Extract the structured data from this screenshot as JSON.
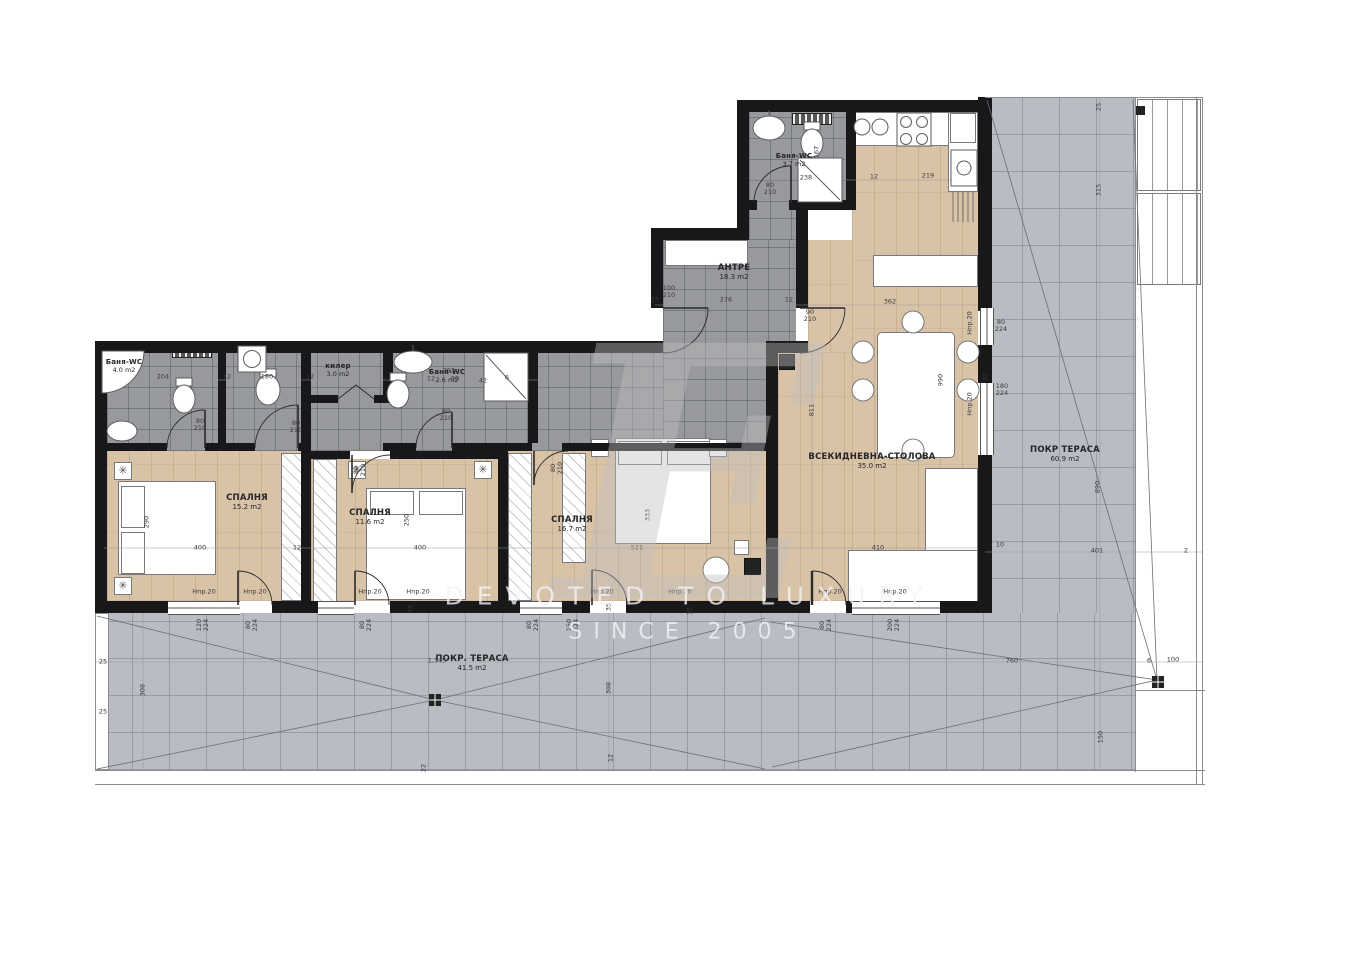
{
  "watermark": {
    "letter": "E",
    "line1": "DEVOTED TO LUXURY",
    "line2": "SINCE 2005"
  },
  "icons": {
    "ceiling_light": "✳"
  },
  "rooms": [
    {
      "id": "bath-1",
      "name": "Баня-WC",
      "area": "4.0 m2",
      "x": 124,
      "y": 366,
      "small": true
    },
    {
      "id": "bedroom-1",
      "name": "СПАЛНЯ",
      "area": "15.2 m2",
      "x": 247,
      "y": 502
    },
    {
      "id": "storage",
      "name": "килер",
      "area": "3.0 m2",
      "x": 338,
      "y": 370,
      "small": true
    },
    {
      "id": "bath-2",
      "name": "Баня-WC",
      "area": "2.6 m2",
      "x": 447,
      "y": 376,
      "small": true
    },
    {
      "id": "bedroom-2",
      "name": "СПАЛНЯ",
      "area": "11.6 m2",
      "x": 370,
      "y": 517
    },
    {
      "id": "bedroom-3",
      "name": "СПАЛНЯ",
      "area": "16.7 m2",
      "x": 572,
      "y": 524
    },
    {
      "id": "hall",
      "name": "АНТРЕ",
      "area": "18.3 m2",
      "x": 734,
      "y": 272
    },
    {
      "id": "bath-3",
      "name": "Баня-WC",
      "area": "3.7 m2",
      "x": 794,
      "y": 160,
      "small": true
    },
    {
      "id": "living",
      "name": "ВСЕКИДНЕВНА-СТОЛОВА",
      "area": "35.0 m2",
      "x": 872,
      "y": 461
    },
    {
      "id": "terrace-right",
      "name": "ПОКР ТЕРАСА",
      "area": "60.9 m2",
      "x": 1065,
      "y": 454
    },
    {
      "id": "terrace-bottom",
      "name": "ПОКР. ТЕРАСА",
      "area": "41.5 m2",
      "x": 472,
      "y": 663
    }
  ],
  "dims": [
    {
      "t": "167",
      "x": 817,
      "y": 152,
      "r": 1
    },
    {
      "t": "238",
      "x": 806,
      "y": 178
    },
    {
      "t": "12",
      "x": 874,
      "y": 177
    },
    {
      "t": "219",
      "x": 928,
      "y": 176
    },
    {
      "t": "362",
      "x": 890,
      "y": 302
    },
    {
      "t": "276",
      "x": 726,
      "y": 300
    },
    {
      "t": "25",
      "x": 655,
      "y": 300
    },
    {
      "t": "12",
      "x": 789,
      "y": 300
    },
    {
      "t": "100\n210",
      "x": 669,
      "y": 292
    },
    {
      "t": "90\n210",
      "x": 810,
      "y": 316
    },
    {
      "t": "80\n210",
      "x": 770,
      "y": 189
    },
    {
      "t": "204",
      "x": 163,
      "y": 377
    },
    {
      "t": "12",
      "x": 227,
      "y": 377
    },
    {
      "t": "180",
      "x": 267,
      "y": 377
    },
    {
      "t": "12",
      "x": 310,
      "y": 377
    },
    {
      "t": "293",
      "x": 449,
      "y": 371
    },
    {
      "t": "12",
      "x": 431,
      "y": 379
    },
    {
      "t": "90",
      "x": 455,
      "y": 379
    },
    {
      "t": "42",
      "x": 483,
      "y": 381
    },
    {
      "t": "6",
      "x": 507,
      "y": 378
    },
    {
      "t": "80\n210",
      "x": 200,
      "y": 425
    },
    {
      "t": "80\n210",
      "x": 296,
      "y": 427
    },
    {
      "t": "80\n210",
      "x": 446,
      "y": 415
    },
    {
      "t": "80\n210",
      "x": 360,
      "y": 470,
      "r": 1
    },
    {
      "t": "80\n210",
      "x": 557,
      "y": 468,
      "r": 1
    },
    {
      "t": "290",
      "x": 147,
      "y": 522,
      "r": 1
    },
    {
      "t": "400",
      "x": 200,
      "y": 548
    },
    {
      "t": "12",
      "x": 297,
      "y": 548
    },
    {
      "t": "250",
      "x": 407,
      "y": 520,
      "r": 1
    },
    {
      "t": "400",
      "x": 420,
      "y": 548
    },
    {
      "t": "333",
      "x": 648,
      "y": 515,
      "r": 1
    },
    {
      "t": "521",
      "x": 637,
      "y": 548
    },
    {
      "t": "811",
      "x": 812,
      "y": 410,
      "r": 1
    },
    {
      "t": "410",
      "x": 878,
      "y": 548
    },
    {
      "t": "990",
      "x": 941,
      "y": 380,
      "r": 1
    },
    {
      "t": "35",
      "x": 986,
      "y": 377,
      "r": 1
    },
    {
      "t": "Нпр.20",
      "x": 970,
      "y": 323,
      "r": 1
    },
    {
      "t": "80\n224",
      "x": 1001,
      "y": 326
    },
    {
      "t": "Нпр.20",
      "x": 970,
      "y": 404,
      "r": 1
    },
    {
      "t": "180\n224",
      "x": 1002,
      "y": 390
    },
    {
      "t": "10",
      "x": 1000,
      "y": 545
    },
    {
      "t": "Нпр.20",
      "x": 204,
      "y": 592
    },
    {
      "t": "Нпр.20",
      "x": 255,
      "y": 592
    },
    {
      "t": "Нпр.20",
      "x": 370,
      "y": 592
    },
    {
      "t": "Нпр.20",
      "x": 418,
      "y": 592
    },
    {
      "t": "Нпр.20",
      "x": 602,
      "y": 592
    },
    {
      "t": "Нпр.20",
      "x": 680,
      "y": 592
    },
    {
      "t": "Нпр.20",
      "x": 830,
      "y": 592
    },
    {
      "t": "Нпр.20",
      "x": 895,
      "y": 592
    },
    {
      "t": "120\n224",
      "x": 203,
      "y": 625,
      "r": 1
    },
    {
      "t": "80\n224",
      "x": 252,
      "y": 625,
      "r": 1
    },
    {
      "t": "80\n224",
      "x": 366,
      "y": 625,
      "r": 1
    },
    {
      "t": "80\n224",
      "x": 533,
      "y": 625,
      "r": 1
    },
    {
      "t": "150\n224",
      "x": 573,
      "y": 625,
      "r": 1
    },
    {
      "t": "80\n224",
      "x": 826,
      "y": 625,
      "r": 1
    },
    {
      "t": "200\n224",
      "x": 894,
      "y": 625,
      "r": 1
    },
    {
      "t": "35",
      "x": 411,
      "y": 609,
      "r": 1
    },
    {
      "t": "35",
      "x": 609,
      "y": 607,
      "r": 1
    },
    {
      "t": "35",
      "x": 690,
      "y": 611,
      "r": 1
    },
    {
      "t": "1,345",
      "x": 437,
      "y": 661
    },
    {
      "t": "308",
      "x": 143,
      "y": 690,
      "r": 1
    },
    {
      "t": "308",
      "x": 609,
      "y": 688,
      "r": 1
    },
    {
      "t": "25",
      "x": 103,
      "y": 662
    },
    {
      "t": "25",
      "x": 103,
      "y": 712
    },
    {
      "t": "760",
      "x": 1012,
      "y": 661
    },
    {
      "t": "6",
      "x": 1149,
      "y": 661
    },
    {
      "t": "100",
      "x": 1173,
      "y": 660
    },
    {
      "t": "150",
      "x": 1101,
      "y": 737,
      "r": 1
    },
    {
      "t": "890",
      "x": 1098,
      "y": 487,
      "r": 1
    },
    {
      "t": "401",
      "x": 1097,
      "y": 551
    },
    {
      "t": "2",
      "x": 1186,
      "y": 551
    },
    {
      "t": "315",
      "x": 1099,
      "y": 190,
      "r": 1
    },
    {
      "t": "25",
      "x": 1099,
      "y": 107,
      "r": 1
    },
    {
      "t": "12",
      "x": 611,
      "y": 758,
      "r": 1
    },
    {
      "t": "22",
      "x": 424,
      "y": 768,
      "r": 1
    }
  ]
}
